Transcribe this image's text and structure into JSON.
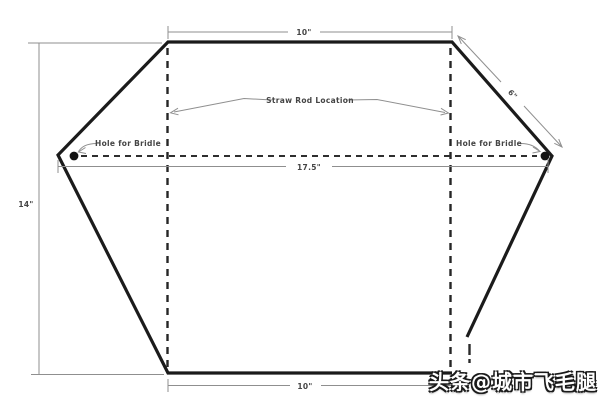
{
  "diagram": {
    "type": "hexagonal-kite-plan",
    "labels": {
      "top_width": "10\"",
      "upper_right_edge_length": "6\"",
      "middle_width": "17.5\"",
      "left_height": "14\"",
      "bottom_width": "10\"",
      "straw_rod": "Straw Rod Location",
      "hole_for_bridle_left": "Hole for Bridle",
      "hole_for_bridle_right": "Hole for Bridle"
    },
    "colors": {
      "outline": "#1b1b1b",
      "dashed_line": "#2a2a2a",
      "dimension_line": "#8f8f8f",
      "label_text": "#454545",
      "background": "#ffffff"
    }
  },
  "watermark": {
    "text": "头条@城市飞毛腿",
    "text_color": "#ffffff",
    "outline_color": "#1a1a1a"
  }
}
